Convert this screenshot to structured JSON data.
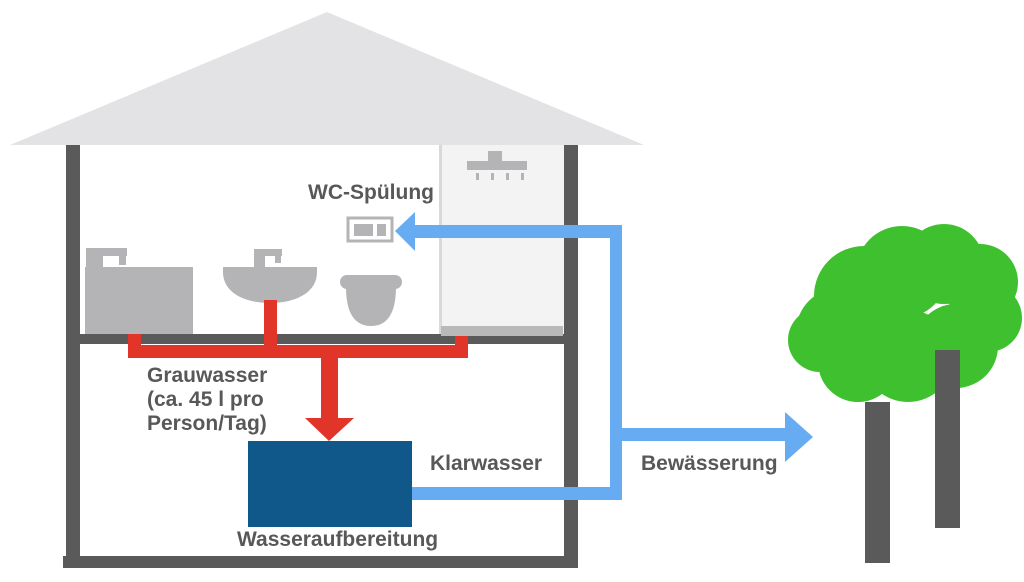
{
  "title": "Grauwasser-Recycling Schema",
  "labels": {
    "wc_spuelung": "WC-Spülung",
    "grauwasser": "Grauwasser\n(ca. 45 l pro\nPerson/Tag)",
    "klarwasser": "Klarwasser",
    "wasseraufbereitung": "Wasseraufbereitung",
    "bewaesserung": "Bewässerung"
  },
  "values": {
    "greywater_amount": "ca. 45 l pro Person/Tag"
  },
  "icons": [
    "house-roof",
    "house-wall",
    "bathtub-icon",
    "faucet-icon",
    "sink-icon",
    "toilet-icon",
    "flush-plate-icon",
    "shower-head-icon",
    "shower-tray",
    "greywater-pipe",
    "greywater-arrow",
    "treatment-tank",
    "clearwater-pipe",
    "wc-feed-arrow",
    "irrigation-arrow",
    "tree-canopy",
    "tree-trunk"
  ],
  "colors": {
    "red": "#e1352a",
    "blue": "#67acf2",
    "tank": "#10588a",
    "green": "#3fc12f",
    "wall": "#5a5a5a",
    "fixture": "#b4b4b6",
    "roof": "#e3e3e5",
    "tint": "#f3f3f4",
    "partition": "#d9d9d9",
    "tray": "#b9b9b9",
    "text": "#58585a"
  }
}
